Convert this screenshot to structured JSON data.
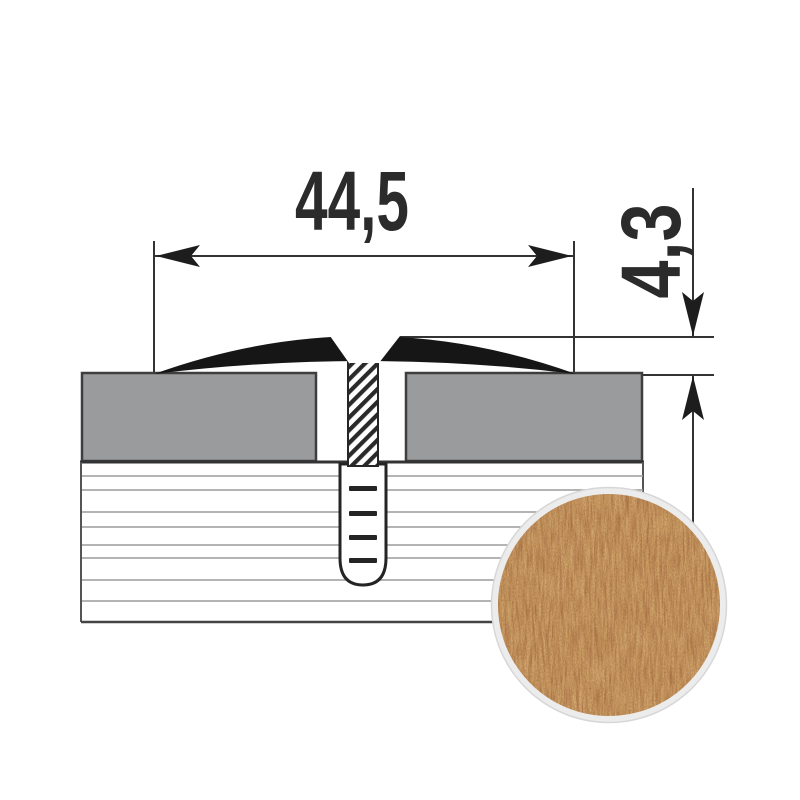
{
  "diagram": {
    "width_dimension": {
      "label": "44,5"
    },
    "height_dimension": {
      "label": "4,3"
    }
  },
  "colors": {
    "line": "#333333",
    "profile_black": "#161616",
    "panel_gray": "#9a9b9d",
    "panel_edge": "#3e3e3e",
    "subfloor_line": "#9b9b9b",
    "hatch_dark": "#2a2a2a",
    "wood_base": "#c8995f",
    "wood_streak_dark": "#a1663f",
    "wood_streak_light": "#dfb87e",
    "swatch_ring": "#ececec"
  }
}
